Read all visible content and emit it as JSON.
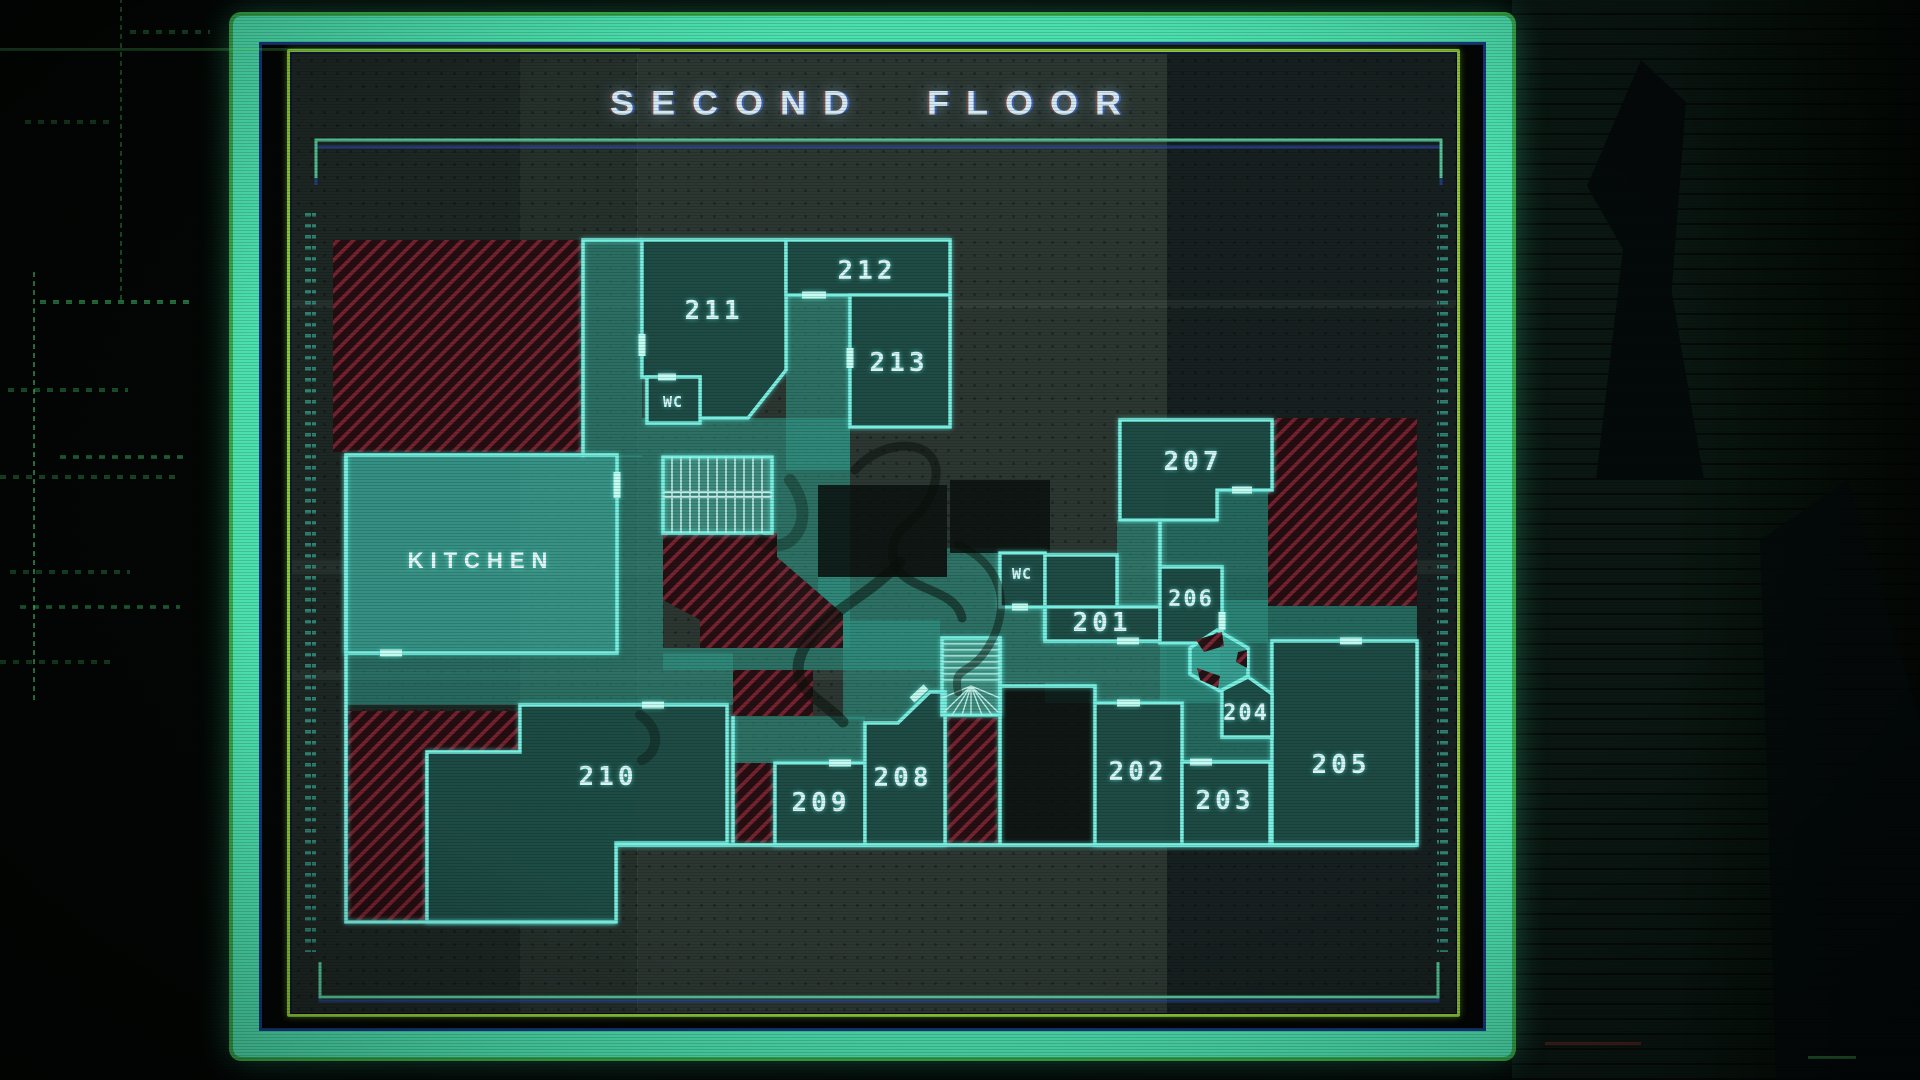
{
  "header": {
    "title": "SECOND FLOOR"
  },
  "map": {
    "rooms": [
      {
        "id": "201",
        "label": "201"
      },
      {
        "id": "202",
        "label": "202"
      },
      {
        "id": "203",
        "label": "203"
      },
      {
        "id": "204",
        "label": "204"
      },
      {
        "id": "205",
        "label": "205"
      },
      {
        "id": "206",
        "label": "206"
      },
      {
        "id": "207",
        "label": "207"
      },
      {
        "id": "208",
        "label": "208"
      },
      {
        "id": "209",
        "label": "209"
      },
      {
        "id": "210",
        "label": "210"
      },
      {
        "id": "211",
        "label": "211"
      },
      {
        "id": "212",
        "label": "212"
      },
      {
        "id": "213",
        "label": "213"
      }
    ],
    "kitchen": {
      "label": "KITCHEN"
    },
    "wc": [
      {
        "label": "WC"
      },
      {
        "label": "WC"
      }
    ]
  },
  "colors": {
    "frame": "#4ce0ae",
    "frame_edge": "#46c15c",
    "frame_inner_line": "#8cc838",
    "wall": "#79efe2",
    "corridor_fill": "#2e9485",
    "room_fill": "#0b1210",
    "blocked_stripe": "#8e2532",
    "label_text": "#d8f4f6",
    "title_text": "#d4e9f2"
  }
}
